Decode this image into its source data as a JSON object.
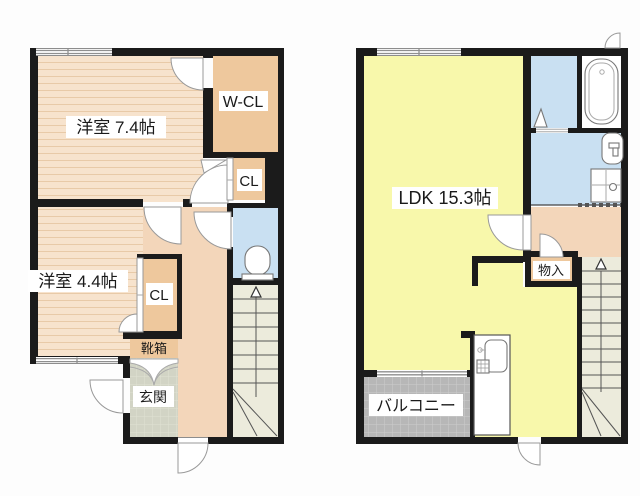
{
  "floorplan": {
    "floor1": {
      "room_7_4": "洋室 7.4帖",
      "walk_in_closet": "W-CL",
      "closet_upper": "CL",
      "room_4_4": "洋室 4.4帖",
      "closet_lower": "CL",
      "shoe_box": "靴箱",
      "entrance": "玄関"
    },
    "floor2": {
      "ldk": "LDK 15.3帖",
      "storage": "物入",
      "balcony": "バルコニー"
    },
    "colors": {
      "wall": "#1b1b1b",
      "room_floor": "#f7e3cd",
      "closet": "#eec89d",
      "water_area": "#c9e0f2",
      "hallway": "#f3d6ba",
      "ldk": "#f8f8ab",
      "stairs": "#ecebdc",
      "balcony": "#b7b7b7",
      "entrance_tile": "#d2d4c5"
    }
  }
}
